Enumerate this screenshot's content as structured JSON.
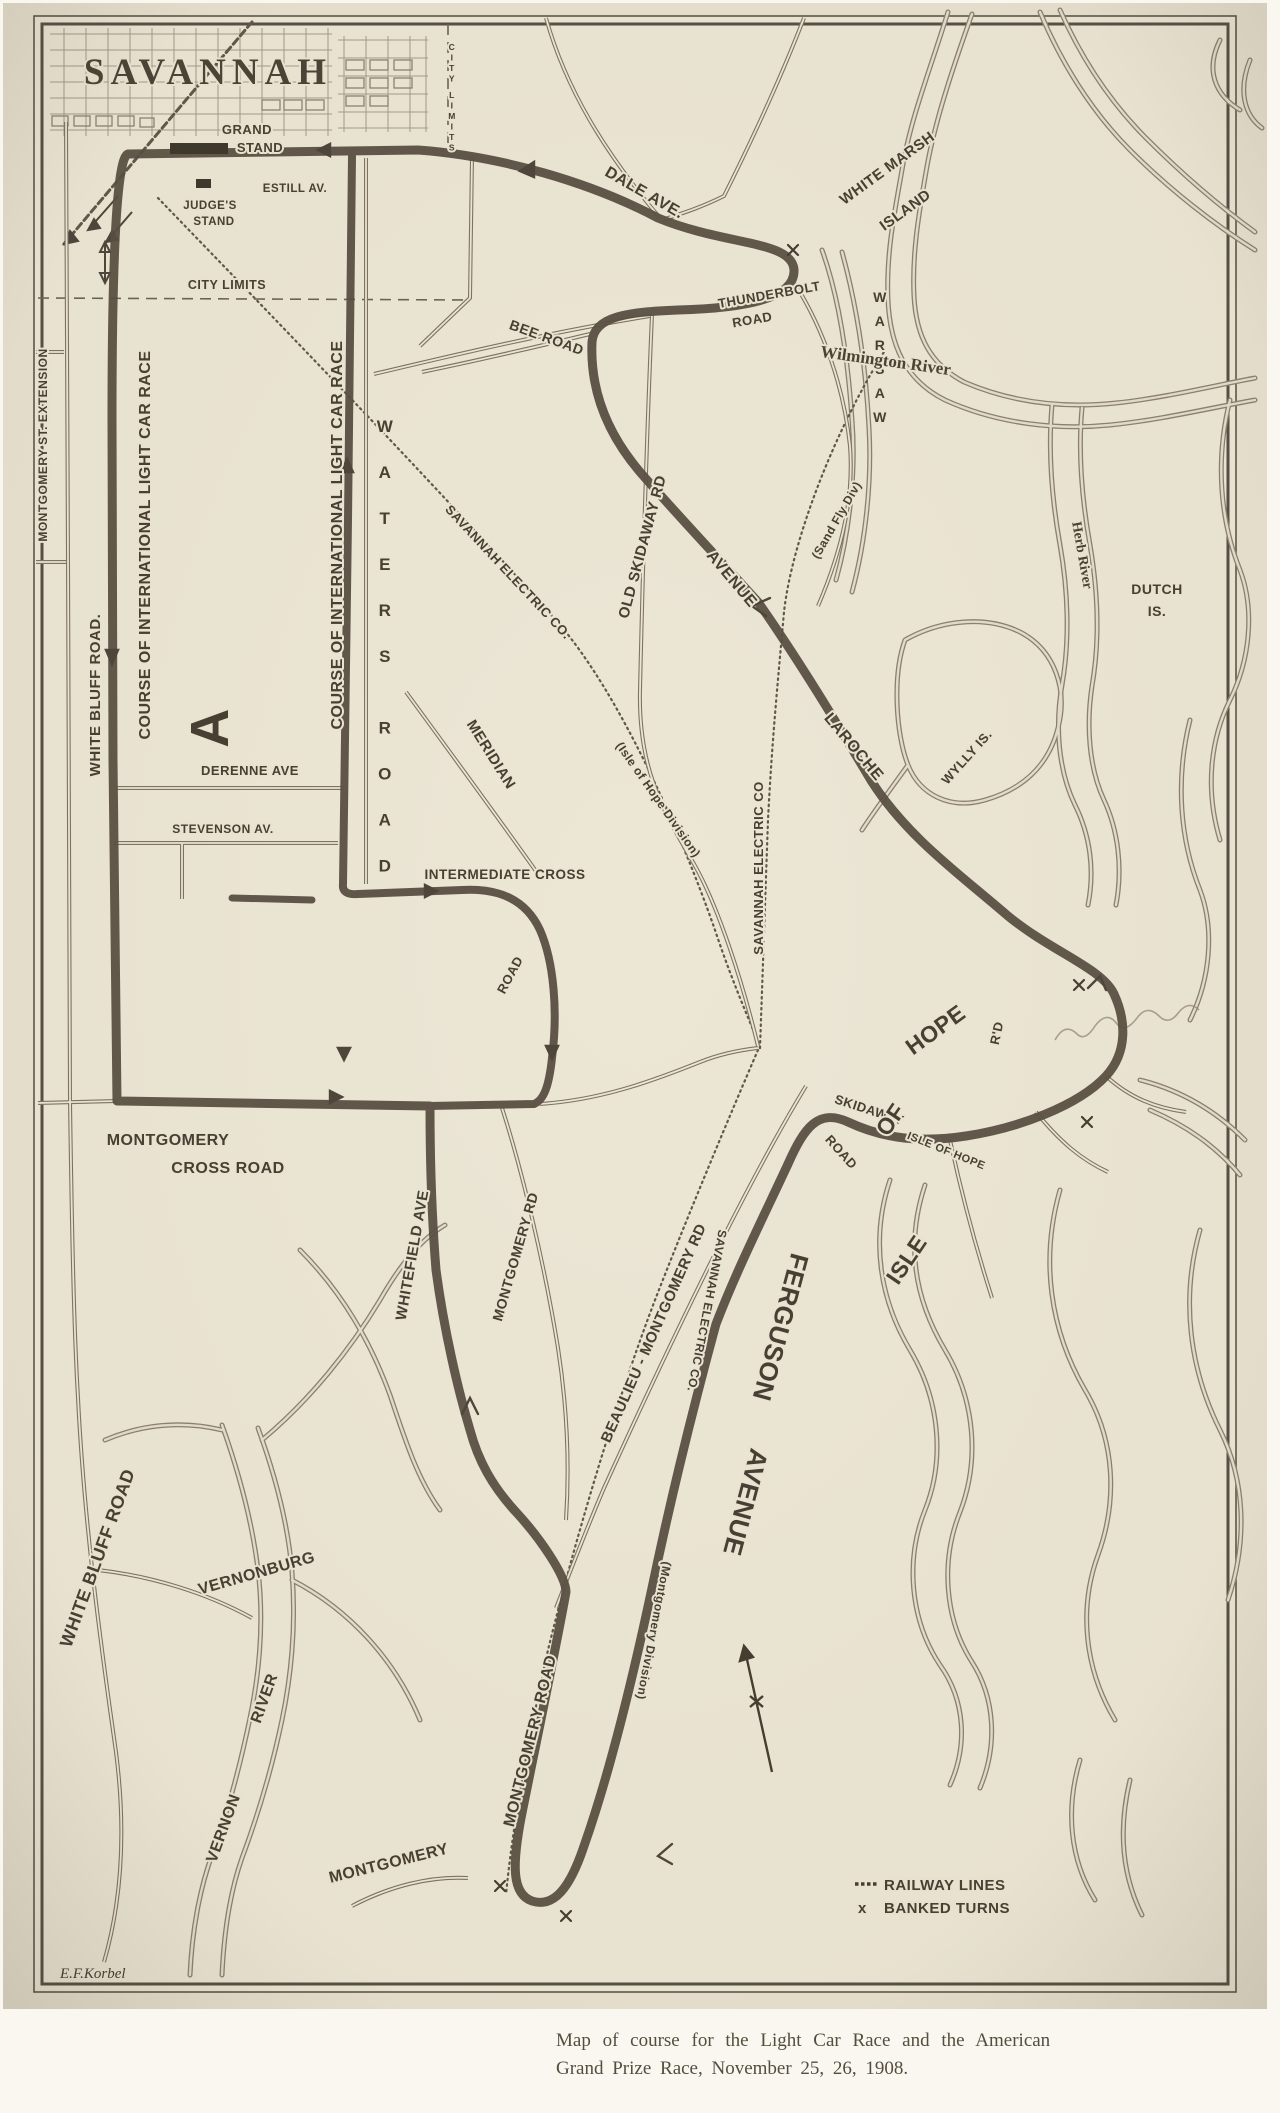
{
  "photo": {
    "caption_line1": "Map of course for the Light Car Race and the American",
    "caption_line2": "Grand Prize Race, November 25, 26, 1908."
  },
  "map": {
    "title": "SAVANNAH",
    "signature": "E.F.Korbel",
    "legend": {
      "railway_label": "RAILWAY LINES",
      "banked_label": "BANKED TURNS",
      "banked_symbol": "x"
    },
    "labels": {
      "grand": "GRAND",
      "grand2": "STAND",
      "judges": "JUDGE'S",
      "judges2": "STAND",
      "estill": "ESTILL AV.",
      "city_limits": "CITY LIMITS",
      "city_limits_v": "CITY LIMITS",
      "dale": "DALE AVE.",
      "thunderbolt": "THUNDERBOLT",
      "thunderbolt2": "ROAD",
      "bee": "BEE ROAD",
      "warsaw": "WARSAW",
      "white_marsh": "WHITE MARSH",
      "white_marsh2": "ISLAND",
      "wilmington": "Wilmington River",
      "dutch": "DUTCH",
      "dutch2": "IS.",
      "herb": "Herb River",
      "wylly": "WYLLY IS.",
      "montgomery_ext": "MONTGOMERY ST. EXTENSION",
      "white_bluff": "WHITE BLUFF ROAD.",
      "course_left": "COURSE OF INTERNATIONAL LIGHT CAR RACE",
      "course_right": "COURSE OF INTERNATIONAL LIGHT CAR RACE",
      "derenne": "DERENNE AVE",
      "stevenson": "STEVENSON AV.",
      "block_a": "A",
      "waters": "WATERS ROAD",
      "meridian": "MERIDIAN",
      "intermediate": "INTERMEDIATE CROSS",
      "intermediate2": "ROAD",
      "sav_elec_ioh": "SAVANNAH ELECTRIC CO.",
      "sav_elec_ioh2": "(Isle of Hope Division)",
      "old_skidaway": "OLD SKIDAWAY RD",
      "laroche": "LAROCHE",
      "laroche2": "AVENUE",
      "sav_elec_main": "SAVANNAH ELECTRIC CO",
      "sand_fly": "(Sand Fly Div)",
      "mont_cross": "MONTGOMERY",
      "mont_cross2": "CROSS ROAD",
      "skidaway": "SKIDAWAY",
      "skidaway2": "ROAD",
      "isle_big": "ISLE",
      "of_big": "OF",
      "hope_big": "HOPE",
      "ioh_rd": "ISLE OF HOPE",
      "ioh_rd2": "R'D",
      "whitefield": "WHITEFIELD AVE",
      "montgomery_rd": "MONTGOMERY RD",
      "beaulieu": "BEAULIEU - MONTGOMERY RD",
      "sav_elec_mont": "SAVANNAH ELECTRIC CO.",
      "sav_elec_mont2": "(Montgomery Division)",
      "ferguson": "FERGUSON",
      "ferguson2": "AVENUE",
      "montgomery_road": "MONTGOMERY ROAD",
      "vernonburg": "VERNONBURG",
      "vernon": "VERNON",
      "vernon2": "RIVER",
      "white_bluff_s": "WHITE BLUFF ROAD",
      "montgomery_s": "MONTGOMERY"
    }
  }
}
